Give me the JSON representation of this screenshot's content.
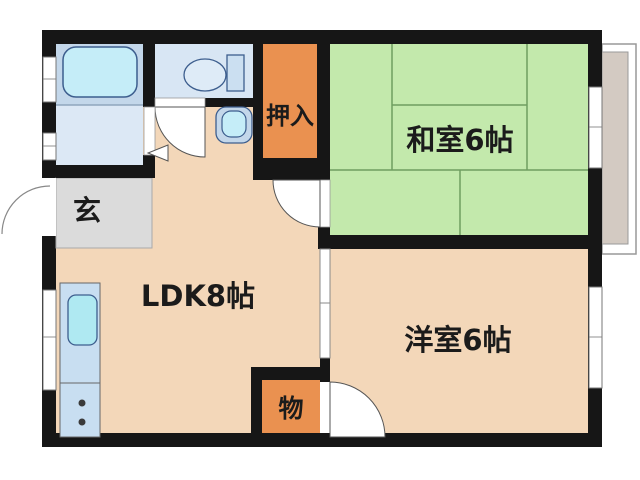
{
  "floorplan": {
    "title": "1LDK apartment floor plan",
    "rooms": {
      "washitsu": {
        "label": "和室6帖"
      },
      "youshitsu": {
        "label": "洋室6帖"
      },
      "ldk": {
        "label": "LDK8帖"
      },
      "oshiire": {
        "label": "押入"
      },
      "mono": {
        "label": "物"
      },
      "genkan": {
        "label": "玄"
      }
    },
    "colors": {
      "wall": "#161616",
      "floor_beige": "#F3D7B9",
      "washitsu_green": "#C3E9AC",
      "tatami_line": "#6f9e60",
      "closet_orange": "#EA9150",
      "genkan_gray": "#DBDBDB",
      "bathroom_blue": "#C3D7EA",
      "washroom_blue": "#DCE8F5",
      "toilet_blue": "#D8E6F4",
      "fixture_cyan": "#C5EDF8",
      "fixture_light": "#DEEBF7",
      "tank_blue": "#CBDFF1",
      "kitchen_blue": "#C8DEF1",
      "sink_cyan": "#AFE9F2",
      "balcony_gray": "#D3CAC2",
      "door_white": "#FFFFFF"
    }
  }
}
